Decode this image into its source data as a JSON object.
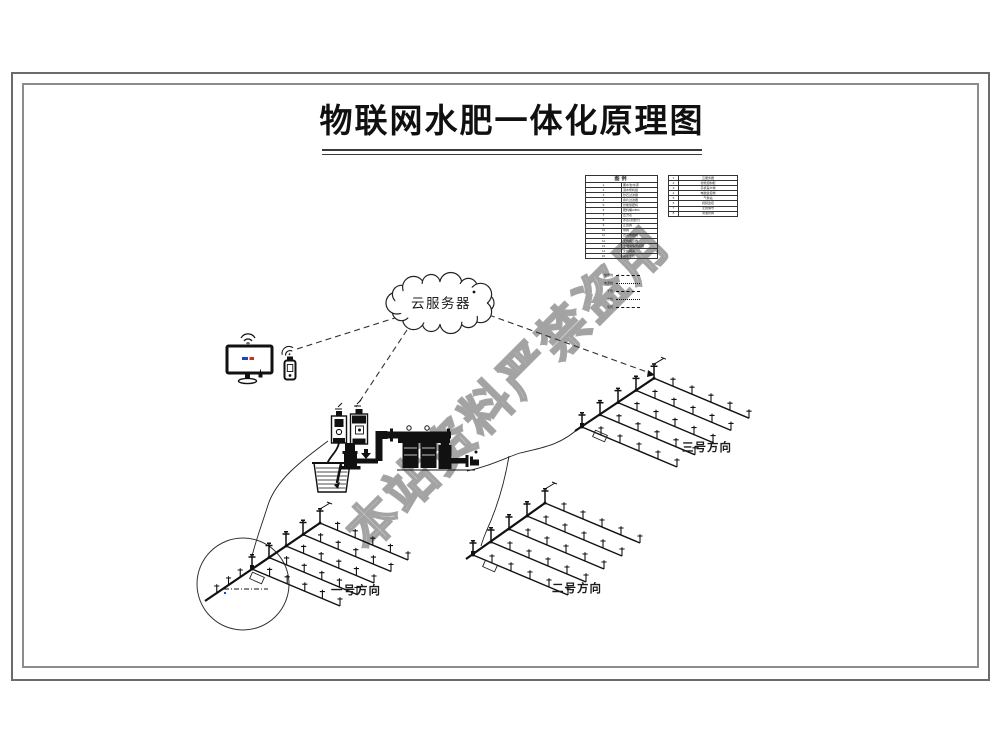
{
  "title": "物联网水肥一体化原理图",
  "watermark": "本站资料严禁盗用",
  "cloud": {
    "label": "云服务器"
  },
  "legend": {
    "header": "图例",
    "left_rows": [
      {
        "no": "1",
        "label": "蓄水池/水源"
      },
      {
        "no": "2",
        "label": "潜水泵机组"
      },
      {
        "no": "3",
        "label": "砂石过滤器"
      },
      {
        "no": "4",
        "label": "叠片过滤器"
      },
      {
        "no": "5",
        "label": "智能施肥机"
      },
      {
        "no": "6",
        "label": "肥料桶A/B/C"
      },
      {
        "no": "7",
        "label": "压力表"
      },
      {
        "no": "8",
        "label": "水表(流量计)"
      },
      {
        "no": "9",
        "label": "止回阀"
      },
      {
        "no": "10",
        "label": "球阀"
      },
      {
        "no": "11",
        "label": "田间电磁阀"
      },
      {
        "no": "12",
        "label": "无线阀控器"
      },
      {
        "no": "13",
        "label": "土壤墒情传感器"
      },
      {
        "no": "14",
        "label": "无线网关"
      },
      {
        "no": "15",
        "label": "输水干管"
      }
    ],
    "right_rows": [
      {
        "no": "1",
        "label": "云服务器"
      },
      {
        "no": "2",
        "label": "智能控制柜"
      },
      {
        "no": "3",
        "label": "手机客户端"
      },
      {
        "no": "4",
        "label": "电脑监控端"
      },
      {
        "no": "5",
        "label": "气象站"
      },
      {
        "no": "6",
        "label": "视频监控"
      },
      {
        "no": "7",
        "label": "无线信号"
      },
      {
        "no": "8",
        "label": "滴灌管网"
      }
    ],
    "line_samples": [
      {
        "label": "信号线"
      },
      {
        "label": "电源线"
      },
      {
        "label": "干管"
      },
      {
        "label": "支管"
      },
      {
        "label": "毛管"
      }
    ]
  },
  "fields": [
    {
      "label": "一号方向"
    },
    {
      "label": "二号方向"
    },
    {
      "label": "三号方向"
    }
  ],
  "colors": {
    "ink": "#141414",
    "frame_outer": "#6b6b6b",
    "frame_inner": "#8c8c8c",
    "watermark": "#969696",
    "screen_blue": "#2343b8",
    "screen_red": "#c03326"
  }
}
